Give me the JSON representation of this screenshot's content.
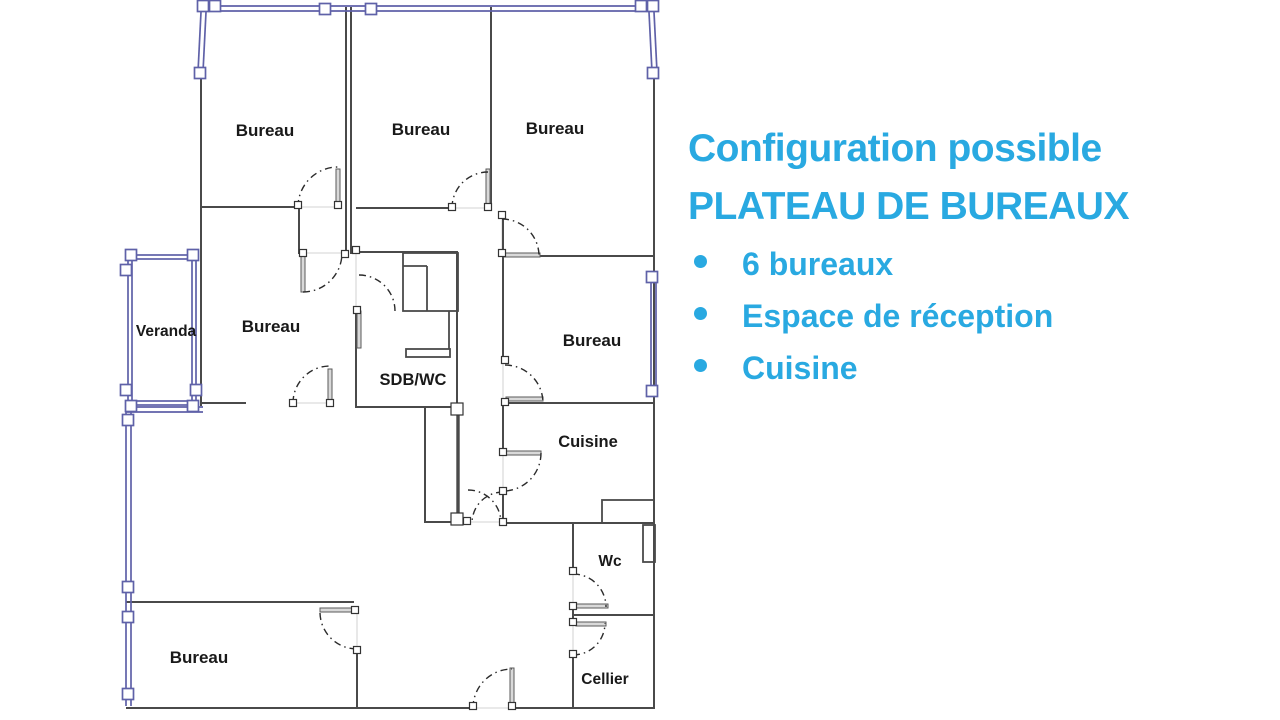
{
  "panel": {
    "title_line1": "Configuration possible",
    "title_line2": "PLATEAU DE BUREAUX",
    "bullets": [
      "6 bureaux",
      "Espace de réception",
      "Cuisine"
    ],
    "accent_color": "#29a9e1"
  },
  "floorplan": {
    "rooms": [
      {
        "id": "bureau-top-left",
        "label": "Bureau"
      },
      {
        "id": "bureau-top-middle",
        "label": "Bureau"
      },
      {
        "id": "bureau-top-right",
        "label": "Bureau"
      },
      {
        "id": "veranda",
        "label": "Veranda"
      },
      {
        "id": "bureau-center-left",
        "label": "Bureau"
      },
      {
        "id": "sdb-wc",
        "label": "SDB/WC"
      },
      {
        "id": "bureau-middle-right",
        "label": "Bureau"
      },
      {
        "id": "cuisine",
        "label": "Cuisine"
      },
      {
        "id": "wc",
        "label": "Wc"
      },
      {
        "id": "bureau-bottom-left",
        "label": "Bureau"
      },
      {
        "id": "cellier",
        "label": "Cellier"
      }
    ],
    "colors": {
      "wall": "#4a4a4a",
      "window_wall": "#5f61a8",
      "door_arc": "#2b2b2b"
    }
  }
}
